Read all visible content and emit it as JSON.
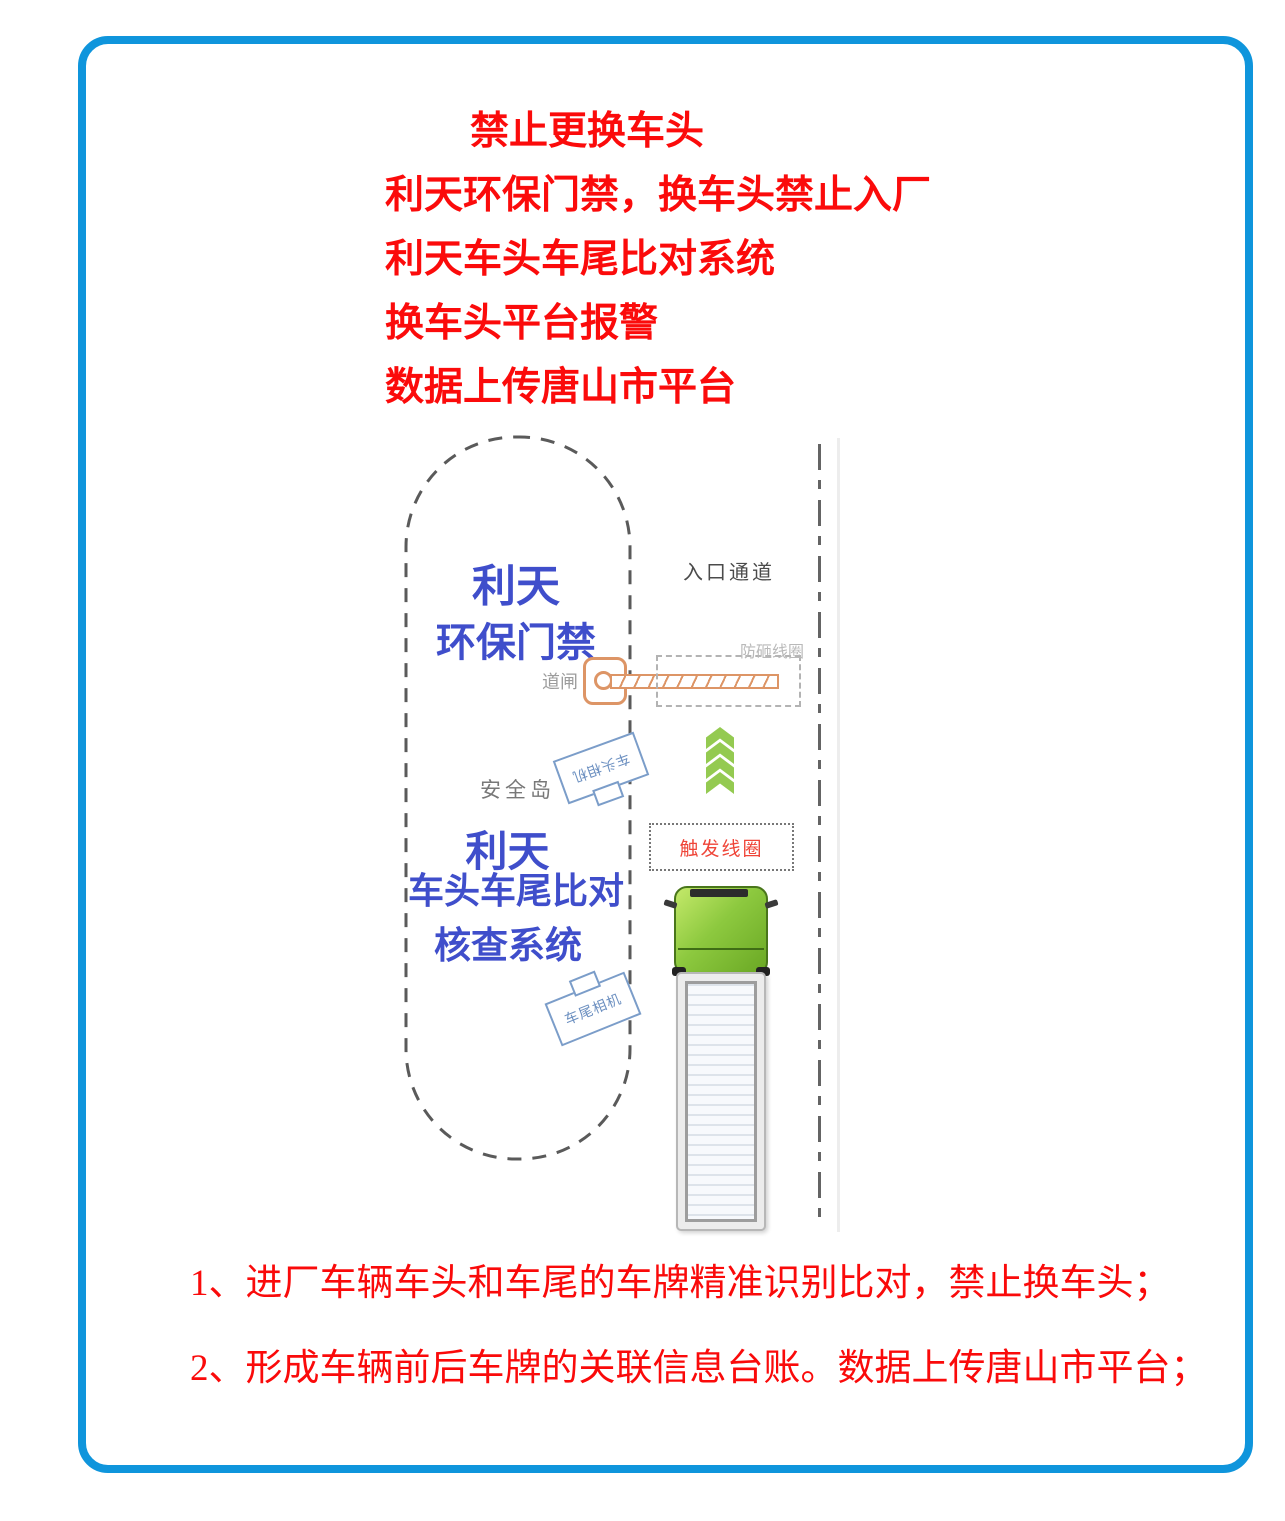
{
  "page": {
    "frame_color": "#0f95dc",
    "background": "#ffffff"
  },
  "header": {
    "text_color": "#fb0b0b",
    "lines": [
      "禁止更换车头",
      "利天环保门禁，换车头禁止入厂",
      "利天车头车尾比对系统",
      "换车头平台报警",
      "数据上传唐山市平台"
    ]
  },
  "diagram": {
    "gate_title_line1": "利天",
    "gate_title_line2": "环保门禁",
    "entrance_label": "入口通道",
    "barrier_label": "道闸",
    "anti_smash_coil_label": "防砸线圈",
    "head_camera_label": "车头相机",
    "island_label": "安全岛",
    "system_line1": "利天",
    "system_line2": "车头车尾比对",
    "system_line3": "核查系统",
    "trigger_coil_label": "触发线圈",
    "tail_camera_label": "车尾相机",
    "colors": {
      "system_text_blue": "#3f4ecb",
      "barrier_orange": "#dd9566",
      "chevron_green": "#94ca51",
      "trigger_text_red": "#ef4538",
      "truck_cab_green": "#8dc93f"
    }
  },
  "footer": {
    "text_color": "#fa0a0a",
    "lines": [
      "1、进厂车辆车头和车尾的车牌精准识别比对，禁止换车头；",
      "2、形成车辆前后车牌的关联信息台账。数据上传唐山市平台；"
    ]
  }
}
